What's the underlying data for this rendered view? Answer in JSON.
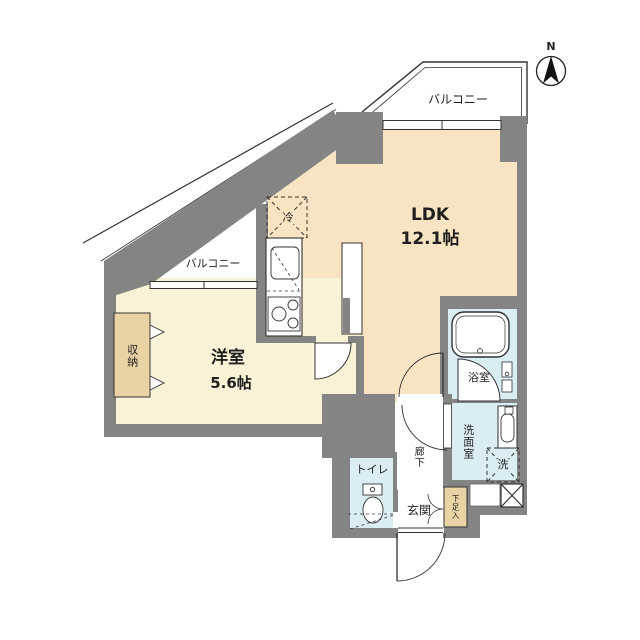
{
  "title": "apartment-floor-plan",
  "compass": {
    "north_label": "N"
  },
  "rooms": {
    "ldk": {
      "name": "LDK",
      "size": "12.1帖"
    },
    "western_room": {
      "name": "洋室",
      "size": "5.6帖"
    },
    "balcony_top": {
      "name": "バルコニー"
    },
    "balcony_left": {
      "name": "バルコニー"
    },
    "storage": {
      "name": "収納"
    },
    "refrigerator": {
      "name": "冷"
    },
    "bathroom": {
      "name": "浴室"
    },
    "washroom": {
      "name": "洗面室"
    },
    "washer": {
      "name": "洗"
    },
    "toilet": {
      "name": "トイレ"
    },
    "entrance": {
      "name": "玄関"
    },
    "hallway": {
      "name": "廊下"
    },
    "shoe_box": {
      "name": "下足入"
    }
  },
  "colors": {
    "wall": "#848484",
    "ldk": "#F8E3C2",
    "western": "#FAF2D6",
    "tan": "#E9D3A4",
    "wet": "#D9EDF3",
    "line": "#2a2a2a"
  }
}
